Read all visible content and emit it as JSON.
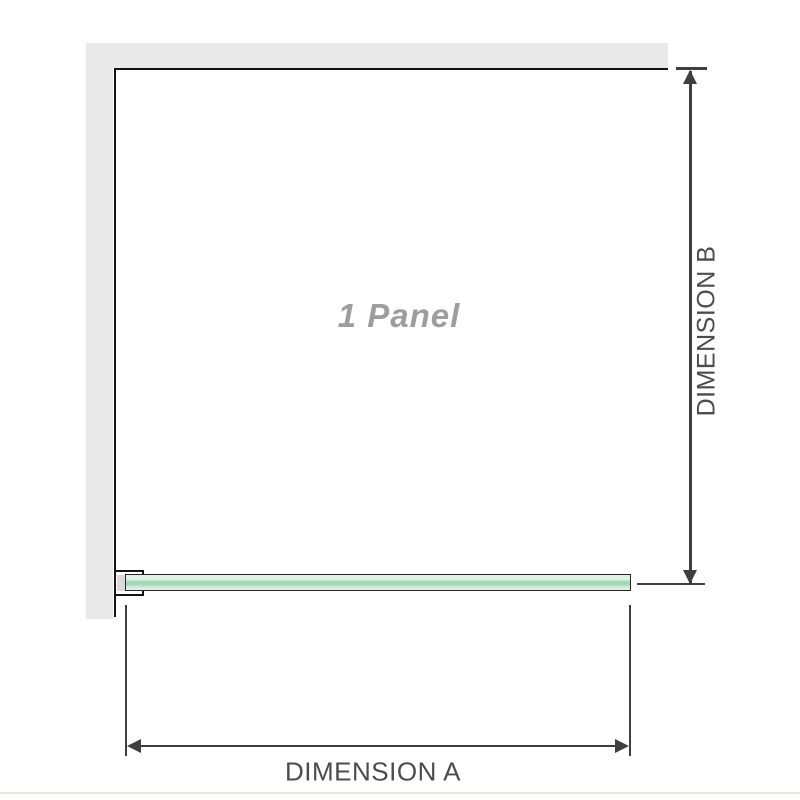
{
  "diagram": {
    "panel_label": "1 Panel",
    "dimension_a_label": "DIMENSION A",
    "dimension_b_label": "DIMENSION B"
  },
  "colors": {
    "wall": "#e9e9e9",
    "outline": "#141414",
    "dimension_line": "#3f3f3f",
    "label_text": "#4c4c4c",
    "panel_text": "#9d9d9d",
    "glass_border": "#262626",
    "glass_green_light": "#dff1e5",
    "glass_green_mid": "#a3d7b4",
    "glass_green_low": "#cfe9d7",
    "bracket_fill": "#ffffff",
    "bracket_insert": "#dadada",
    "divider": "#e8e4e0"
  }
}
